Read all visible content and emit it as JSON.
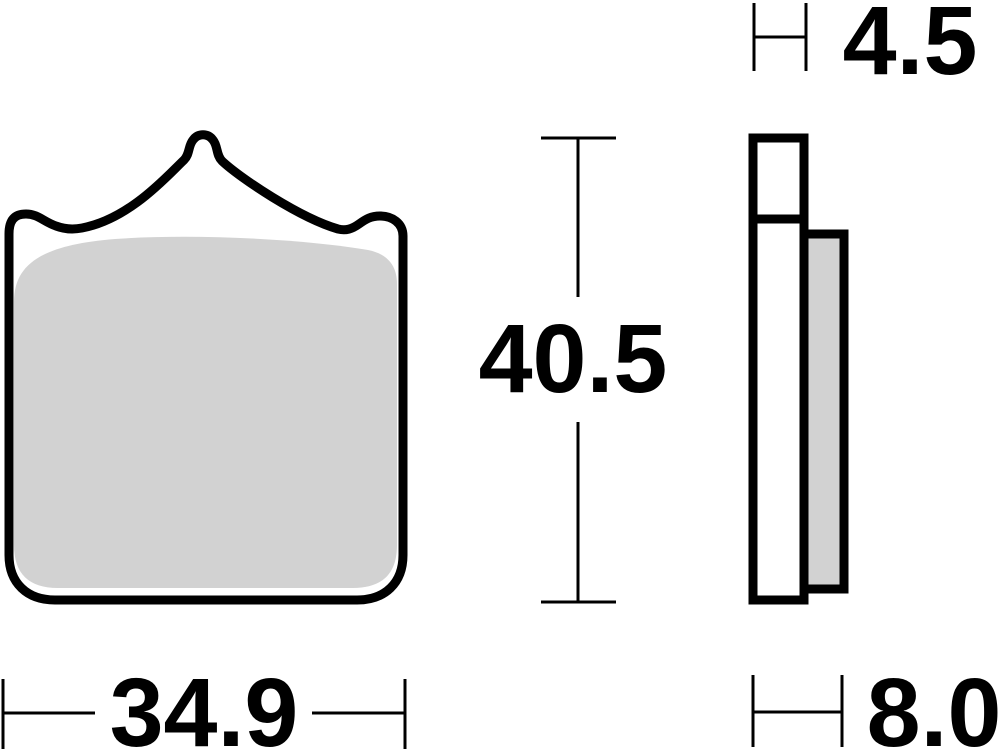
{
  "drawing": {
    "colors": {
      "line": "#000000",
      "friction_material": "#d2d2d2",
      "background": "#ffffff"
    },
    "dimensions": {
      "front_width": {
        "label": "34.9"
      },
      "front_height": {
        "label": "40.5"
      },
      "backplate_thickness": {
        "label": "4.5"
      },
      "total_thickness": {
        "label": "8.0"
      }
    }
  }
}
